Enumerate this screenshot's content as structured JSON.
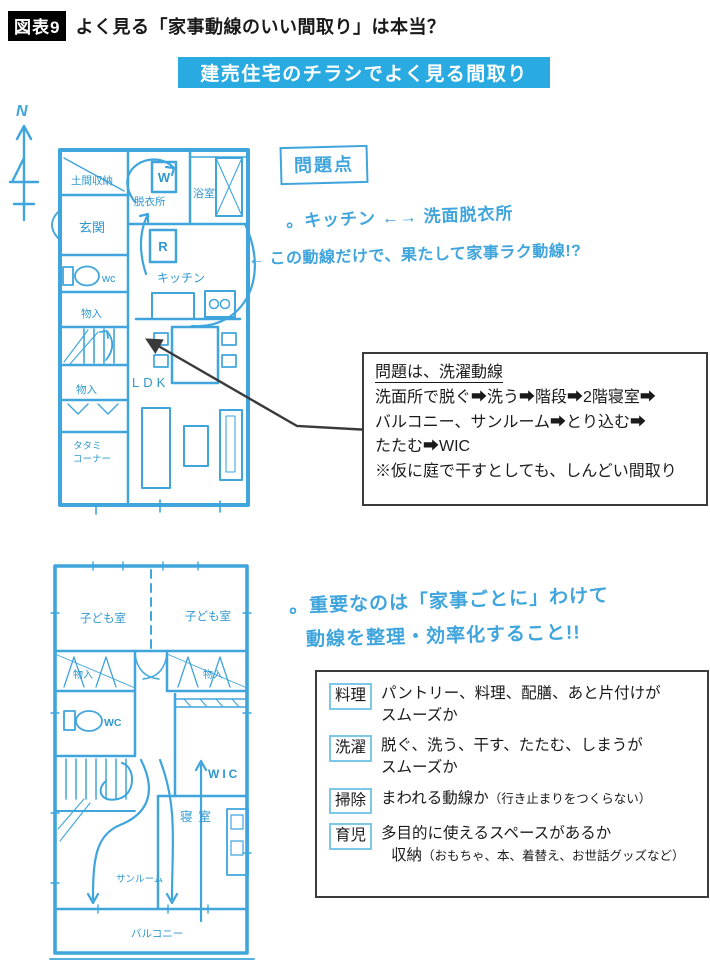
{
  "header": {
    "tag": "図表9",
    "title": "よく見る「家事動線のいい間取り」は本当？"
  },
  "banner": {
    "text": "建売住宅のチラシでよく見る間取り"
  },
  "compass": {
    "label": "N"
  },
  "plan1": {
    "rooms": {
      "doma": "土間収納",
      "genkan": "玄関",
      "datsui": "脱衣所",
      "bath": "浴室",
      "washer": "W",
      "fridge": "R",
      "wc": "wc",
      "kitchen": "キッチン",
      "mono_upper": "物入",
      "mono_lower": "物入",
      "tatami1": "タタミ",
      "tatami2": "コーナー",
      "ldk": "LDK"
    }
  },
  "notes1": {
    "problem_title": "問題点",
    "line1": "。キッチン ←→ 洗面脱衣所",
    "line2": "← この動線だけで、果たして家事ラク動線!?"
  },
  "problem_box": {
    "title": "問題は、洗濯動線",
    "lines": [
      "洗面所で脱ぐ➡洗う➡階段➡2階寝室➡",
      "バルコニー、サンルーム➡とり込む➡",
      "たたむ➡WIC",
      "※仮に庭で干すとしても、しんどい間取り"
    ]
  },
  "plan2": {
    "rooms": {
      "kids_left": "子ども室",
      "kids_right": "子ども室",
      "mono_left": "物入",
      "mono_right": "物入",
      "wc": "WC",
      "wic": "WIC",
      "bedroom": "寝室",
      "sunroom": "サンルーム",
      "balcony": "バルコニー"
    }
  },
  "notes2": {
    "line1": "。重要なのは「家事ごとに」わけて",
    "line2": "動線を整理・効率化すること!!"
  },
  "checklist": {
    "items": [
      {
        "label": "料理",
        "text": "パントリー、料理、配膳、あと片付けが",
        "text2": "スムーズか"
      },
      {
        "label": "洗濯",
        "text": "脱ぐ、洗う、干す、たたむ、しまうが",
        "text2": "スムーズか"
      },
      {
        "label": "掃除",
        "text": "まわれる動線か",
        "small": "（行き止まりをつくらない）"
      },
      {
        "label": "育児",
        "text": "多目的に使えるスペースがあるか",
        "text2": "収納",
        "small": "（おもちゃ、本、着替え、お世話グッズなど）"
      }
    ]
  },
  "colors": {
    "sketch_blue": "#3fa5dc",
    "banner_cyan": "#29abe2",
    "label_border_cyan": "#7cc8e8",
    "ink": "#1a1a1a"
  }
}
